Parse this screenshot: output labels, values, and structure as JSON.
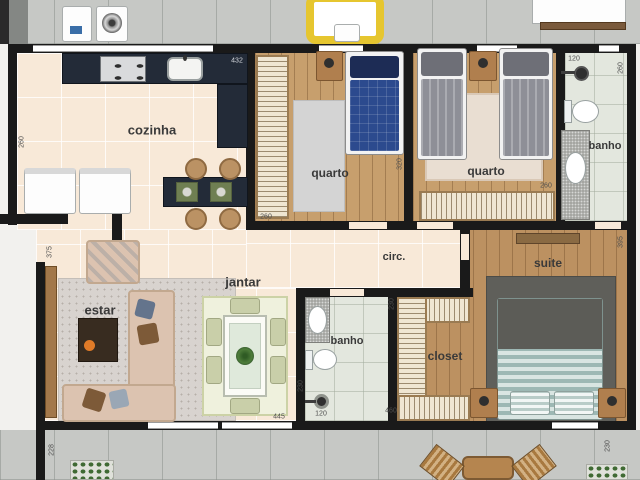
{
  "rooms": {
    "cozinha": {
      "label": "cozinha"
    },
    "quarto1": {
      "label": "quarto"
    },
    "quarto2": {
      "label": "quarto"
    },
    "banho1": {
      "label": "banho"
    },
    "circulacao": {
      "label": "circ."
    },
    "estar": {
      "label": "estar"
    },
    "jantar": {
      "label": "jantar"
    },
    "banho2": {
      "label": "banho"
    },
    "closet": {
      "label": "closet"
    },
    "suite": {
      "label": "suite"
    }
  },
  "dimensions": {
    "cozinha_width": "432",
    "cozinha_left": "260",
    "estar_left": "375",
    "terraco_esquerda": "228",
    "quarto1_width": "260",
    "quartos_wall": "320",
    "quarto2_width": "260",
    "banho1_width": "120",
    "banho1_depth": "260",
    "jantar_width": "445",
    "banho2_width": "120",
    "banho2_depth": "230",
    "closet_depth": "230",
    "closet_width": "460",
    "suite_depth": "395",
    "terraco_direita": "230"
  },
  "palette": {
    "wall": "#1a1a1a",
    "kitchen_counter": "#232b38",
    "wood_floor": "#c79f6d",
    "tile_floor": "#f8e9d8",
    "bath_floor": "#e3e7de",
    "terrace": "#c6c8c5",
    "bed_blue": "#2c4a8e",
    "bed_gray": "#8e8f97",
    "suite_bed_stripe": "#a8c0bb",
    "sofa": "#dcc3b0",
    "door_wood": "#a3784a"
  }
}
